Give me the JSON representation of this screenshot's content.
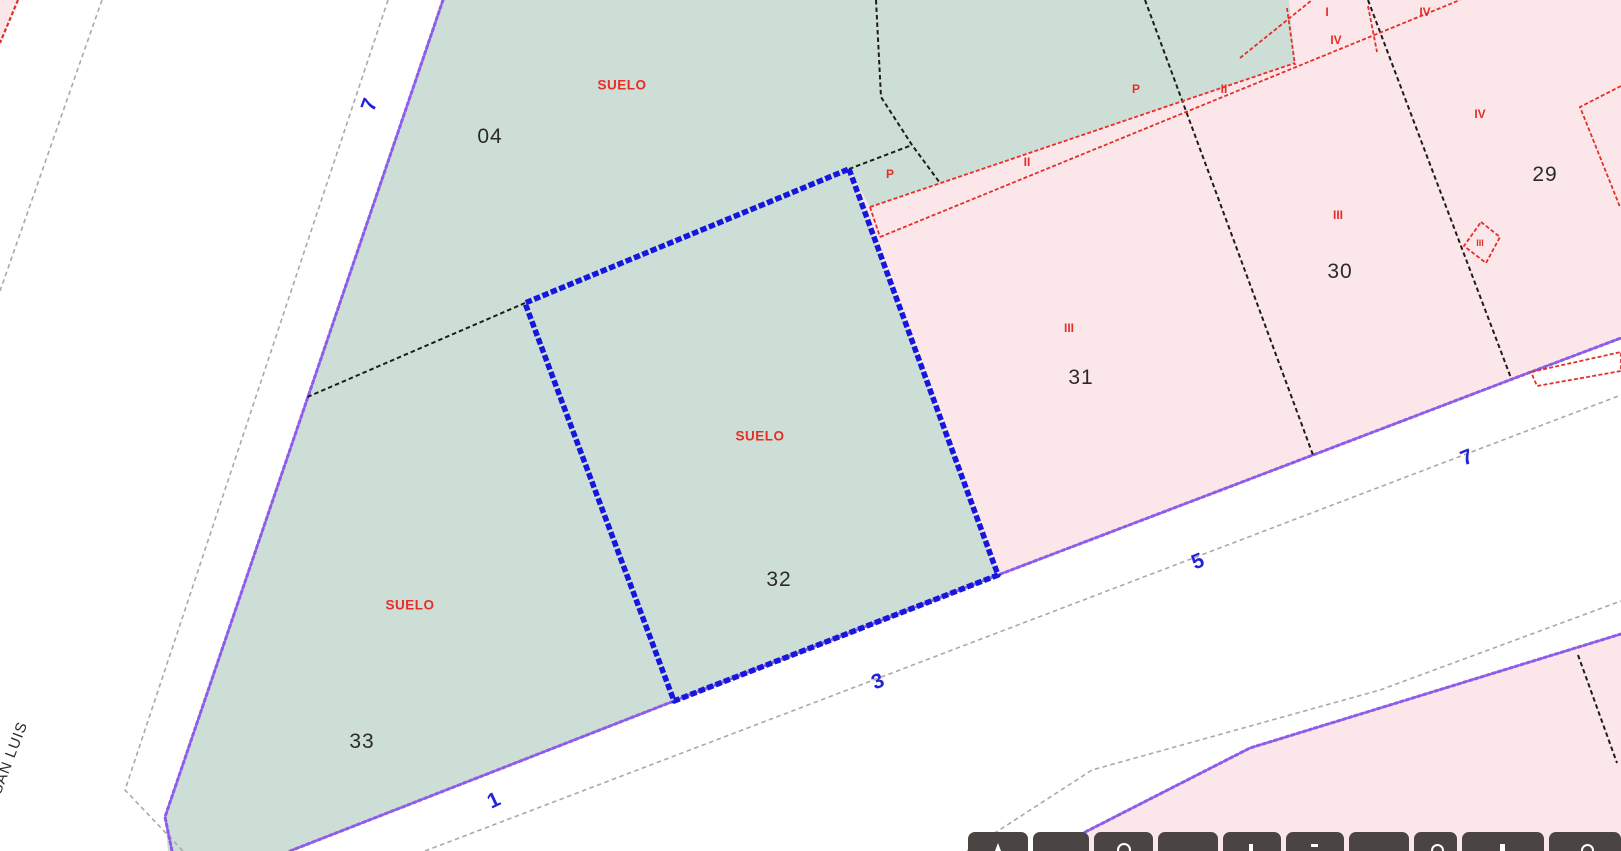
{
  "selected_parcel": "32",
  "street": {
    "name": "SAN LUIS",
    "numbers": {
      "n1": "1",
      "n3": "3",
      "n5": "5",
      "n7": "7"
    }
  },
  "parcels": {
    "p04": "04",
    "p29": "29",
    "p30": "30",
    "p31": "31",
    "p32": "32",
    "p33": "33"
  },
  "land_labels": {
    "suelo": "SUELO"
  },
  "construction_labels": {
    "p": "P",
    "i": "I",
    "ii": "II",
    "iii": "III",
    "iv": "IV"
  },
  "toolbar": {
    "button_count": 10
  },
  "colors": {
    "parcel-green": "#cdded6",
    "parcel-pink": "#fbe7ea",
    "boundary-purple": "#8d5ce8",
    "selected-blue": "#1617dd",
    "construction-red": "#e62e28",
    "line-black": "#1c1c1c",
    "line-gray": "#a9a9a9",
    "label-blue": "#2222d8",
    "label-dark": "#2a2a2a",
    "toolbar-dark": "#4a4543"
  }
}
